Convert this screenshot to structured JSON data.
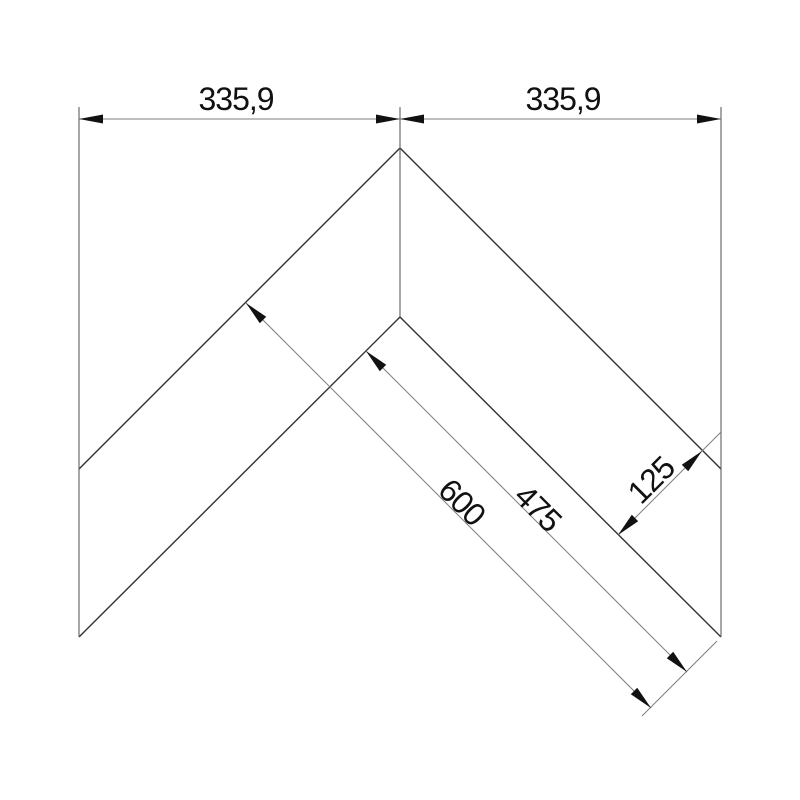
{
  "drawing": {
    "kind": "corner-profile-dimension-drawing",
    "labels": {
      "top_left_width": "335,9",
      "top_right_width": "335,9",
      "outer_leg_length": "600",
      "inner_leg_length": "475",
      "profile_width": "125"
    },
    "colors": {
      "background": "#ffffff",
      "edge": "#333333",
      "dimension_line": "#7d7d7d",
      "arrow": "#111111",
      "text": "#111111"
    }
  }
}
